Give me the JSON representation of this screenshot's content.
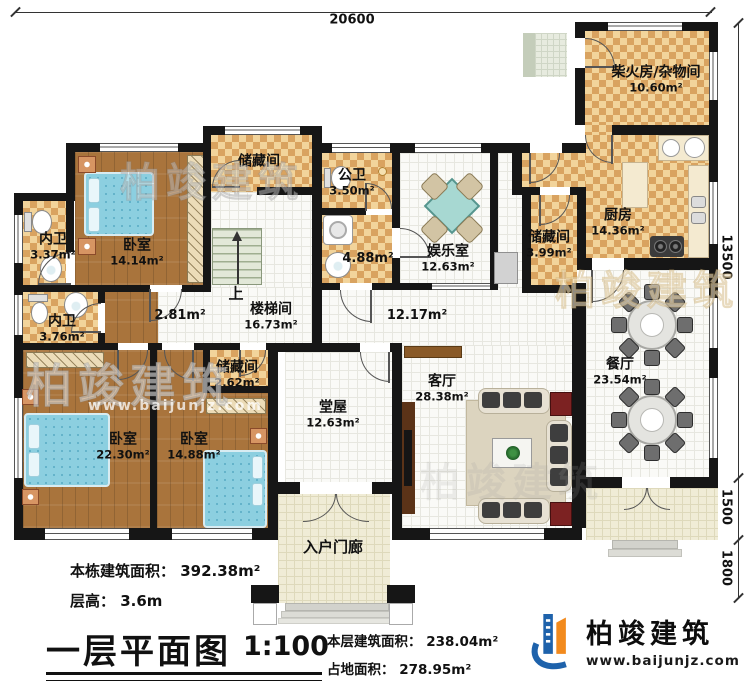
{
  "dims": {
    "top": "20600",
    "right": "13500",
    "right_mid": "1500",
    "right_bottom": "1800"
  },
  "rooms": {
    "bedroom1": {
      "name": "卧室",
      "area": "14.14m²"
    },
    "ensuite1": {
      "name": "内卫",
      "area": "3.37m²"
    },
    "ensuite2": {
      "name": "内卫",
      "area": "3.76m²"
    },
    "bedroom2": {
      "name": "卧室",
      "area": "22.30m²"
    },
    "bedroom3": {
      "name": "卧室",
      "area": "14.88m²"
    },
    "storage_top": {
      "name": "储藏间",
      "area": ""
    },
    "storage_small": {
      "name": "储藏间",
      "area": "2.62m²"
    },
    "storage_right": {
      "name": "储藏间",
      "area": "3.99m²"
    },
    "public_bath": {
      "name": "公卫",
      "area": "3.50m²"
    },
    "laundry": {
      "name": "",
      "area": "4.88m²"
    },
    "stairwell": {
      "name": "楼梯间",
      "area": "16.73m²"
    },
    "hall_small": {
      "name": "",
      "area": "2.81m²"
    },
    "hall_main": {
      "name": "",
      "area": "12.17m²"
    },
    "recreation": {
      "name": "娱乐室",
      "area": "12.63m²"
    },
    "firewood": {
      "name": "柴火房/杂物间",
      "area": "10.60m²"
    },
    "kitchen": {
      "name": "厨房",
      "area": "14.36m²"
    },
    "dining": {
      "name": "餐厅",
      "area": "23.54m²"
    },
    "main_hall": {
      "name": "堂屋",
      "area": "12.63m²"
    },
    "living": {
      "name": "客厅",
      "area": "28.38m²"
    },
    "porch": {
      "name": "入户门廊",
      "area": ""
    }
  },
  "misc": {
    "up": "上"
  },
  "footer": {
    "total_area": "本栋建筑面积： 392.38m²",
    "floor_height": "层高： 3.6m",
    "title": "一层平面图",
    "scale": "1:100",
    "floor_area": "本层建筑面积： 238.04m²",
    "footprint": "占地面积： 278.95m²"
  },
  "logo": {
    "name": "柏竣建筑",
    "url": "www.baijunjz.com"
  },
  "watermark": {
    "text": "柏竣建筑",
    "url": "www.baijunjz.com"
  },
  "colors": {
    "wall": "#161616",
    "tile_accent": "#d9a360",
    "wood": "#a9743c",
    "logo_blue": "#1e62ab",
    "logo_orange": "#f28a1d"
  }
}
